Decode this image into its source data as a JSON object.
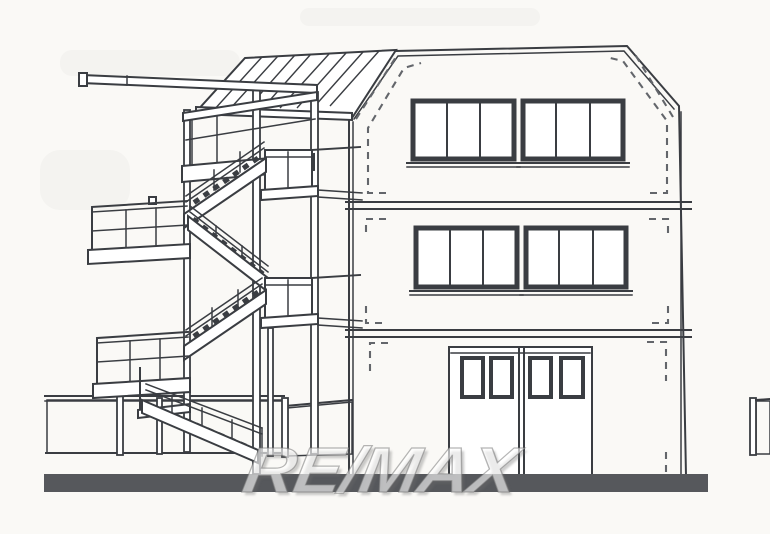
{
  "watermark": {
    "text": "RE/MAX"
  },
  "palette": {
    "background": "#faf9f6",
    "ink": "#3a3d42",
    "ink_soft": "#63666b",
    "ground_bar": "#56585c",
    "hatch": "#b7b4af",
    "hatch_bg": "#efede9",
    "watermark_fill": "rgba(255,255,255,0.60)",
    "watermark_edge": "rgba(120,120,120,0.55)"
  },
  "drawing": {
    "type": "architectural side elevation line drawing",
    "building": {
      "storeys": 3,
      "roof": "chamfered top corners with dashed inset outline",
      "window_groups_per_upper_floor": 2,
      "panes_per_window_group": 3,
      "ground_floor_door_leaves": 2,
      "panes_per_door_leaf": 2
    },
    "staircase": {
      "kind": "external switchback stair tower",
      "flights": 4,
      "balconies": 5,
      "canopy": "striped mono-pitch canopy roof",
      "cantilever_beam": true
    },
    "site": {
      "fence": "diamond-hatch mesh fence with posts and gate gap",
      "ground": "solid dark baseline strip"
    }
  }
}
